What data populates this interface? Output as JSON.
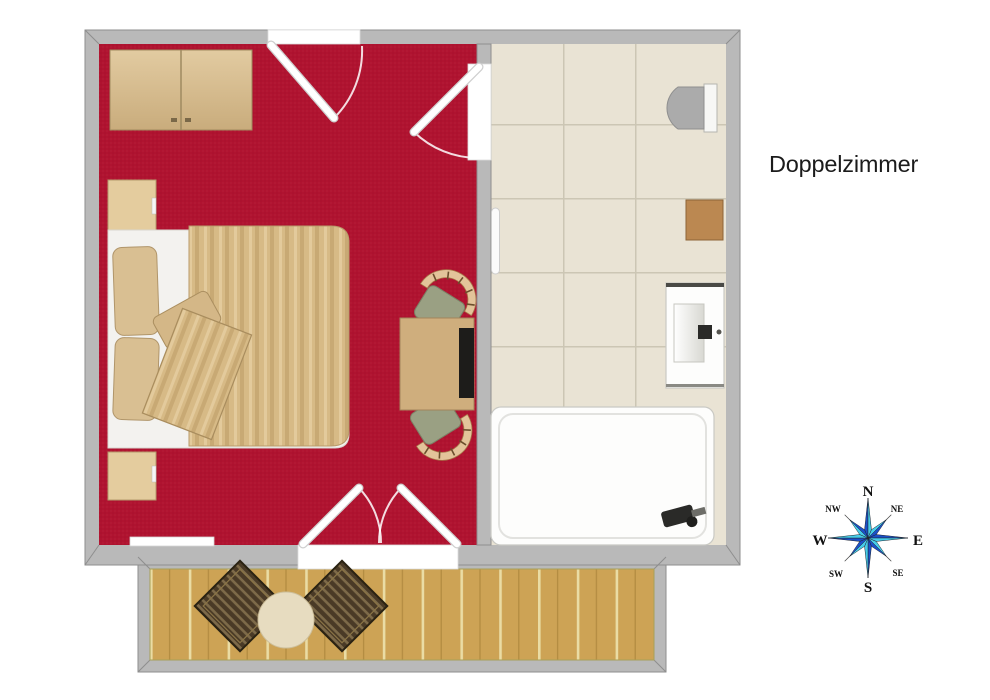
{
  "title": "Doppelzimmer",
  "compass": {
    "n": "N",
    "ne": "NE",
    "e": "E",
    "se": "SE",
    "s": "S",
    "sw": "SW",
    "w": "W",
    "nw": "NW"
  },
  "palette": {
    "carpet": "#b01330",
    "wall": "#b9b9b9",
    "wall_line": "#8e8e8e",
    "tile": "#e9e3d4",
    "grout": "#ccc6b4",
    "wood_light": "#ddc59a",
    "wood_mid": "#cfae7d",
    "deck_wood": "#cda355",
    "duvet": "#d7ba86",
    "pillow": "#d9bf92",
    "sheet": "#f3f2ef",
    "seat": "#9aa083",
    "chair_back": "#e3c49a",
    "balcony_chair": "#4a3a26",
    "fixture_dark": "#2a2a28",
    "toilet_gray": "#ababab",
    "tub_white": "#fdfdfc",
    "compass_dark": "#1b50c8",
    "compass_light": "#46cce8",
    "text": "#1b1b1b"
  }
}
